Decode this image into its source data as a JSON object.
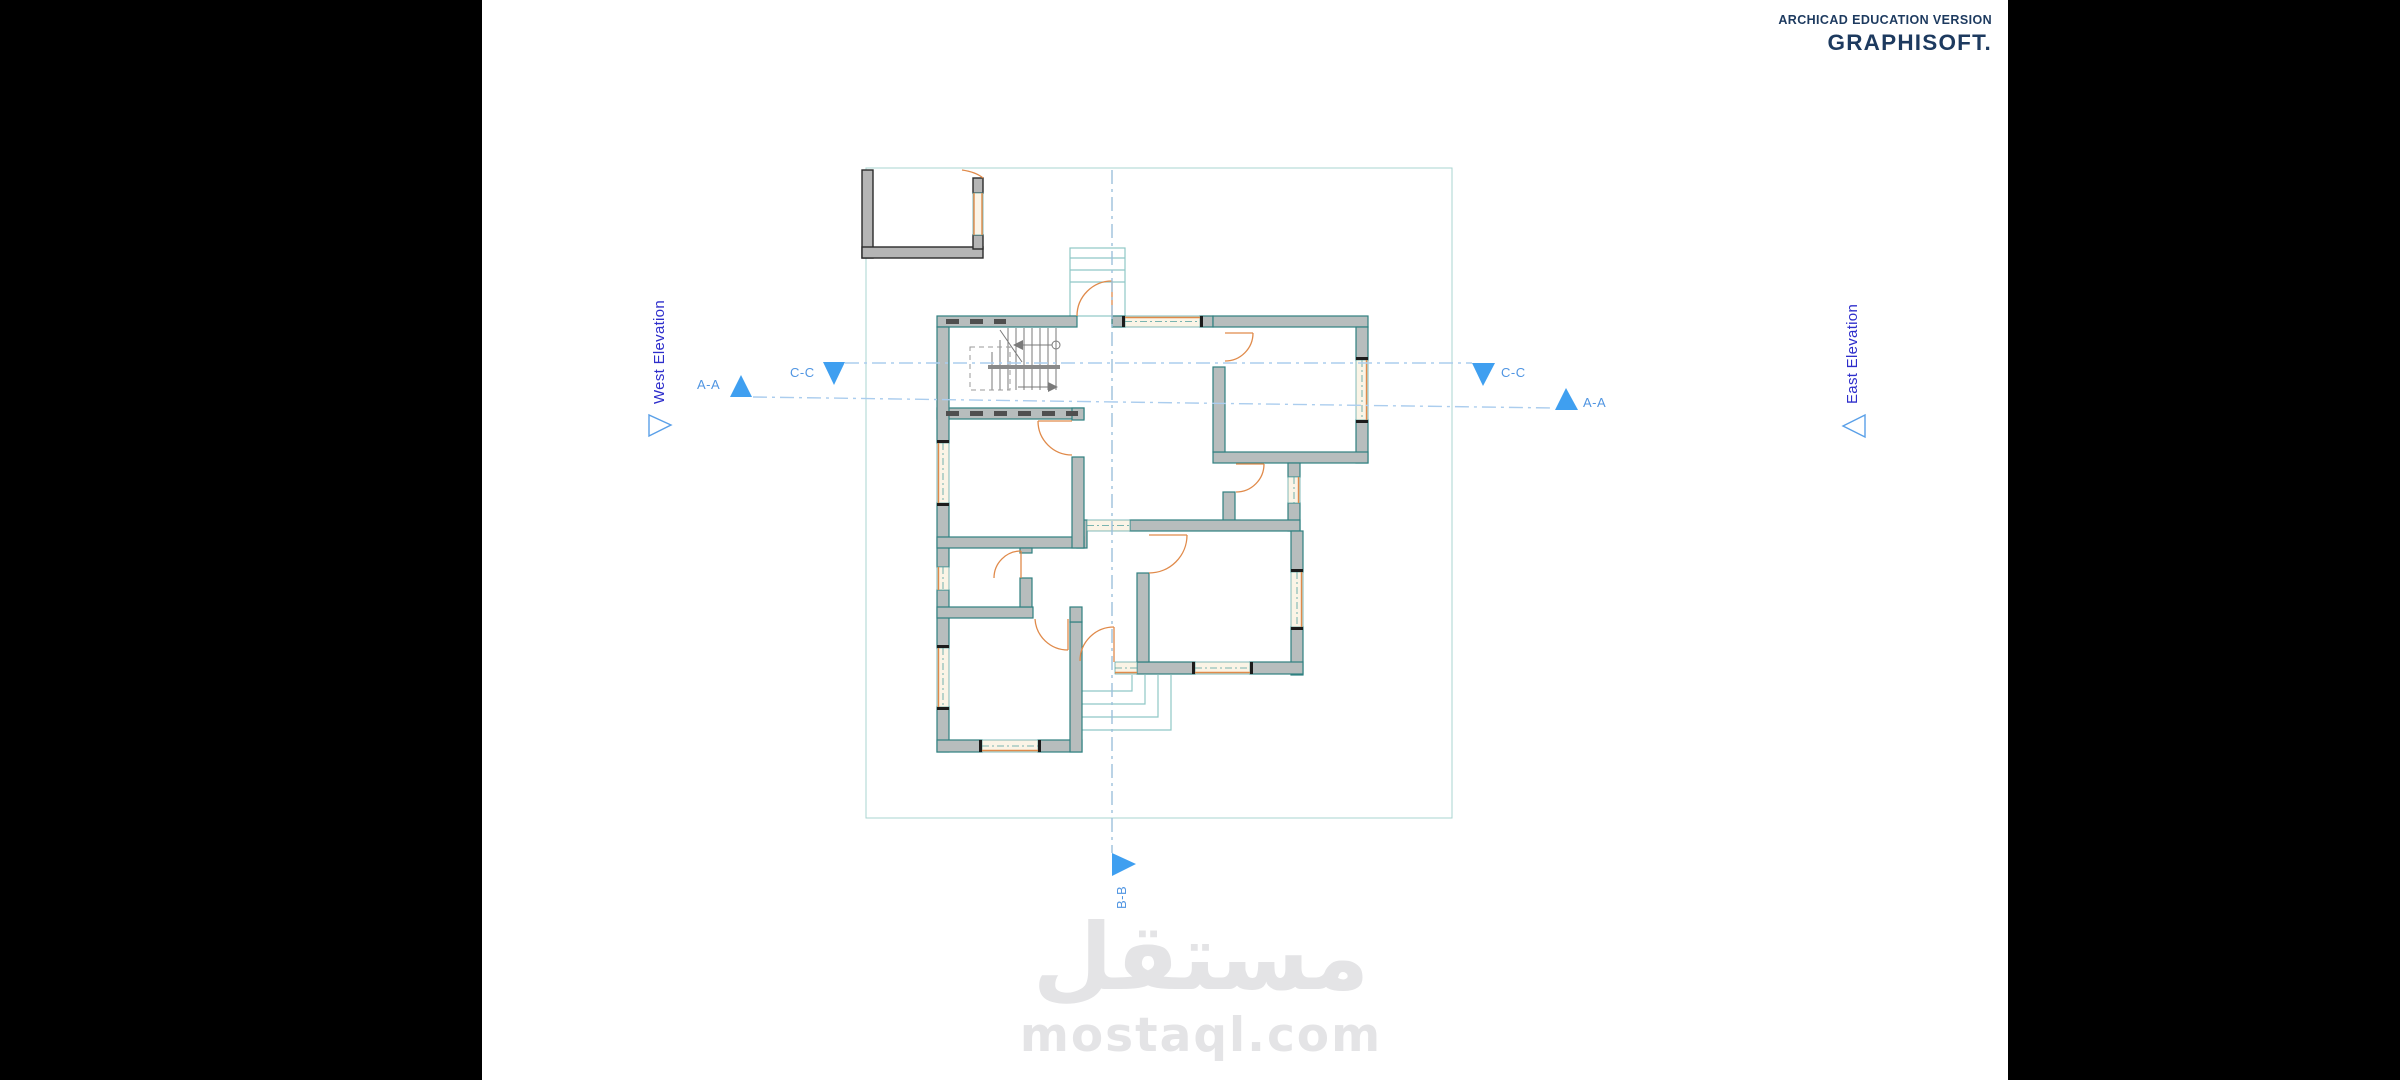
{
  "banner": {
    "line1": "ARCHICAD EDUCATION VERSION",
    "line2": "GRAPHISOFT."
  },
  "markers": {
    "west_elevation": "West Elevation",
    "east_elevation": "East Elevation",
    "aa_left": "A-A",
    "aa_right": "A-A",
    "cc_left": "C-C",
    "cc_right": "C-C",
    "bb": "B-B"
  },
  "watermark": {
    "wordmark": "مستقل",
    "domain": "mostaql.com"
  },
  "colors": {
    "banner_navy": "#1d3a5f",
    "marker_blue": "#3f9ff0",
    "marker_text": "#5095e2",
    "elevation_text": "#2e2ecb",
    "section_line": "#abcdee",
    "wall_outline": "#2f8080",
    "wall_fill": "#b7bdbd",
    "door_orange": "#e08a4a",
    "zone_teal": "#8fc8c6",
    "watermark_gray": "#e4e4e6"
  }
}
